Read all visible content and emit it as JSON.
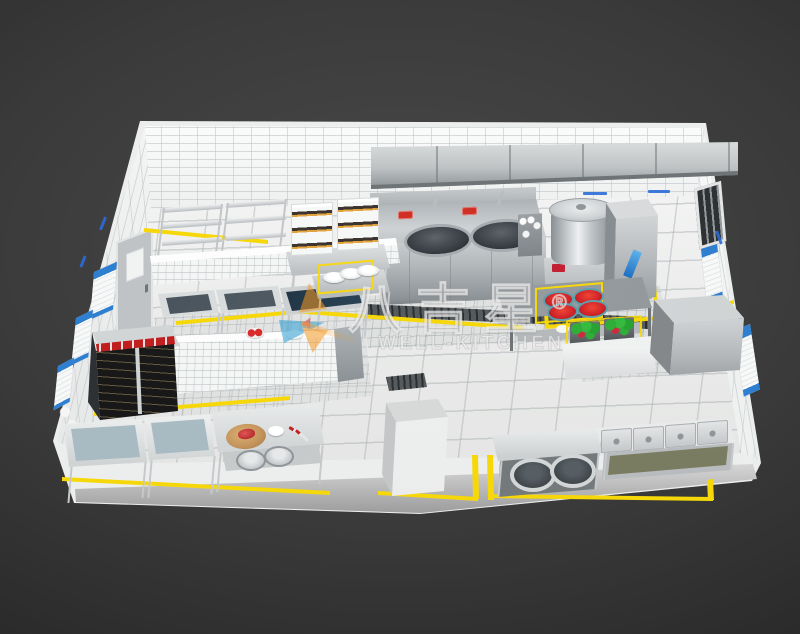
{
  "title": "commercial-kitchen-3d-floorplan-render",
  "watermark": {
    "brand_cn": "八吉星",
    "registered_mark": "®",
    "brand_en": "WELL-KITCHEN"
  },
  "palette": {
    "background_dark": "#3a3a3a",
    "wall_tile_white": "#f5f6f6",
    "floor_tile": "#ecedec",
    "stainless_steel": "#c6cacc",
    "safety_line_yellow": "#f6d80a",
    "wall_label_blue": "#2b6bd8",
    "poster_blue": "#2f7fd0",
    "fridge_band_red": "#bf1f1f",
    "produce_green": "#2fae3a",
    "tomato_red": "#d3273a",
    "watermark_orange": "#f59a23",
    "watermark_blue": "#2e9fd4",
    "drain_gray": "#565b5e"
  },
  "scene": {
    "view": "isometric-birdseye",
    "room": {
      "walls": [
        "back",
        "left",
        "right"
      ],
      "floor_zones": [
        "large-tile-main",
        "fine-tile-cookline",
        "fine-tile-prep",
        "fine-tile-right"
      ]
    },
    "objects": [
      "exhaust-hood",
      "double-wok-range",
      "spice-rack",
      "soup-stockpot",
      "steamer-cabinet",
      "storage-shelving-rack-1",
      "storage-shelving-rack-2",
      "dimsum-steamer-stack-1",
      "dimsum-steamer-stack-2",
      "steamer-table",
      "half-wall-partition-1",
      "half-wall-partition-2",
      "prep-sink-table-1",
      "prep-sink-table-2",
      "dark-top-worktable",
      "worktable-with-plates",
      "glass-door-refrigerator",
      "wall-utensil-rack",
      "veg-washing-sink-1",
      "veg-washing-sink-2",
      "prep-table-cutting-board",
      "pot-shelf",
      "white-cabinet",
      "service-table-red-dishes",
      "vegetable-crates",
      "crate-stand",
      "walk-in-box",
      "pot-counter",
      "bain-marie-counter",
      "floor-drain-long",
      "floor-drain-small",
      "left-wall-door",
      "right-wall-vent-window",
      "wall-posters",
      "equipment-wall-labels",
      "yellow-safety-lines"
    ]
  }
}
